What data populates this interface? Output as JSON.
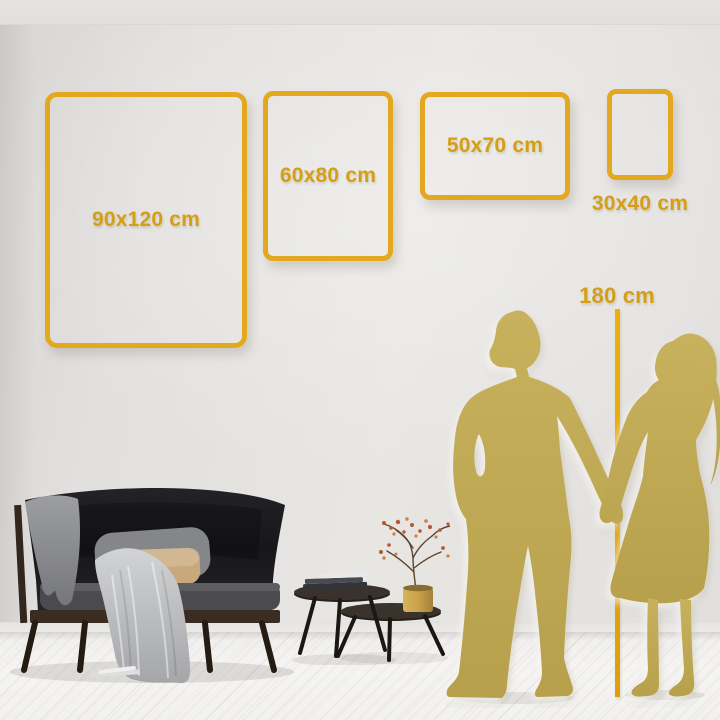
{
  "title": "Wall art size comparison guide",
  "frames": [
    {
      "label": "90x120 cm",
      "width_cm": 90,
      "height_cm": 120
    },
    {
      "label": "60x80 cm",
      "width_cm": 60,
      "height_cm": 80
    },
    {
      "label": "50x70 cm",
      "width_cm": 50,
      "height_cm": 70
    },
    {
      "label": "30x40 cm",
      "width_cm": 30,
      "height_cm": 40
    }
  ],
  "height_reference": {
    "label": "180 cm",
    "cm": 180
  },
  "colors": {
    "frame_gold": "#E3A81F",
    "label_gold": "#D49F16",
    "measure_line_gold": "#E2A60E",
    "silhouette_gold": "#C4AD58",
    "wall": "#E4E2E0",
    "floor": "#F3F2F0",
    "sofa_dark": "#1E1E22",
    "pillow_beige": "#C9A87C",
    "vase_gold": "#C9A24B"
  },
  "decor_items": [
    "dark-sofa",
    "gray-throw-blanket",
    "gray-pillow",
    "beige-pillow",
    "nesting-coffee-tables",
    "book-stack",
    "gold-vase-dried-branches",
    "man-silhouette",
    "woman-silhouette"
  ]
}
